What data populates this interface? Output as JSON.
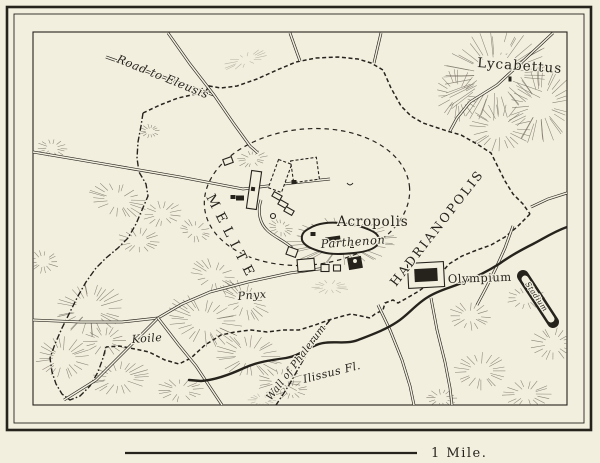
{
  "colors": {
    "paper": "#f2efdf",
    "ink": "#26231d",
    "hachure": "#6e675a"
  },
  "map": {
    "scale_bar": {
      "label": "1 Mile."
    },
    "labels": [
      {
        "id": "road-to-eleusis",
        "text": "Road to Eleusis",
        "style": "italic",
        "size": 11.5,
        "x": 116,
        "y": 62,
        "rotate": 22,
        "spacing": 0.5
      },
      {
        "id": "lycabettus",
        "text": "Lycabettus",
        "style": "roman",
        "size": 13.5,
        "x": 477,
        "y": 67,
        "rotate": 4,
        "spacing": 1
      },
      {
        "id": "melite",
        "text": "MELITE",
        "style": "caps",
        "size": 13.5,
        "x": 206,
        "y": 197,
        "rotate": 63,
        "spacing": 6.5
      },
      {
        "id": "acropolis",
        "text": "Acropolis",
        "style": "roman",
        "size": 13.5,
        "x": 337,
        "y": 226,
        "rotate": 0,
        "spacing": 0.8
      },
      {
        "id": "parthenon",
        "text": "Parthenon",
        "style": "italic",
        "size": 11.5,
        "x": 321,
        "y": 248,
        "rotate": -4,
        "spacing": 0.5
      },
      {
        "id": "hadrianopolis",
        "text": "HADRIANOPOLIS",
        "style": "caps",
        "size": 12.5,
        "x": 396,
        "y": 287,
        "rotate": -52,
        "spacing": 2.2
      },
      {
        "id": "olympium",
        "text": "Olympium",
        "style": "roman",
        "size": 11.5,
        "x": 448,
        "y": 283,
        "rotate": -2,
        "spacing": 0.5
      },
      {
        "id": "pnyx",
        "text": "Pnyx",
        "style": "italic",
        "size": 11,
        "x": 238,
        "y": 300,
        "rotate": -5,
        "spacing": 0.5
      },
      {
        "id": "koile",
        "text": "Koile",
        "style": "italic",
        "size": 11,
        "x": 132,
        "y": 343,
        "rotate": -4,
        "spacing": 0.5
      },
      {
        "id": "wall-of-phalerum",
        "text": "Wall of Phalerum",
        "style": "italic",
        "size": 10,
        "x": 271,
        "y": 401,
        "rotate": -53,
        "spacing": 0.3
      },
      {
        "id": "ilissus-fluvius",
        "text": "Ilissus Fl.",
        "style": "italic",
        "size": 11,
        "x": 304,
        "y": 383,
        "rotate": -14,
        "spacing": 0.5
      },
      {
        "id": "stadium",
        "text": "Stadium",
        "style": "italic",
        "size": 7.5,
        "x": 525,
        "y": 284,
        "rotate": 56,
        "spacing": 0.3
      }
    ],
    "features": [
      {
        "id": "city-wall-north",
        "type": "wall",
        "path": "M143,113 L160,105 L178,98 L196,94 L206,91 L209,86 L221,88 L237,86 L257,79 L277,70 L296,62 L316,58 L338,57 L358,59 L371,63 L383,70 L391,88 L401,106 L411,116 L423,123 L447,131 L461,135 L477,144 L491,153 L498,167 L505,181 L513,194 L523,204 L530,214"
      },
      {
        "id": "city-wall-east",
        "type": "wall",
        "path": "M530,214 L517,227 L505,237 L491,245 L477,250 L462,256 L449,264 L443,271 L431,282 L419,291 L407,298 L398,303 L393,300 L385,303 L383,310 L375,314 L370,318"
      },
      {
        "id": "city-wall-south",
        "type": "wall",
        "path": "M370,318 L361,316 L351,314 L343,316 L329,320 L315,325 L299,330 L283,330 L267,332 L251,330 L235,332 L221,335 L205,345 L191,358 L179,364 L165,360 L149,352 L135,349 L119,346 L106,347"
      },
      {
        "id": "city-wall-west",
        "type": "wall-dashdot",
        "path": "M143,113 L141,126 L138,142 L137,158 L139,172 L146,184 L148,196 L142,210 L136,224 L128,238 L118,248 L106,258 L96,268 L86,282 L78,296 L70,312 L62,328 L55,344 L50,358 L52,372 L56,384 L62,394 L70,400 L80,396 L90,386 L98,372 L103,358 L106,347"
      },
      {
        "id": "phalerum-wall",
        "type": "wall-dashdot",
        "path": "M330,320 L321,331 L313,343 L305,357 L297,371 L289,385 L282,396 L276,405"
      },
      {
        "id": "old-city-boundary",
        "type": "boundary",
        "cx": 307,
        "cy": 197,
        "rx": 103,
        "ry": 68,
        "rot": -6
      },
      {
        "id": "road-to-eleusis-west",
        "type": "road",
        "path": "M106,57 L160,76 L214,95"
      },
      {
        "id": "road-to-eleusis-north",
        "type": "road",
        "path": "M168,33 L190,64 L214,95 L234,124 L250,146 L258,153"
      },
      {
        "id": "north-road-a",
        "type": "road",
        "path": "M290,33 L296,50 L300,61"
      },
      {
        "id": "north-road-b",
        "type": "road",
        "path": "M381,33 L377,50 L374,63"
      },
      {
        "id": "lycabettus-road",
        "type": "road",
        "path": "M553,33 L522,62 L497,85 L470,102 L457,118 L450,131"
      },
      {
        "id": "east-gate-road",
        "type": "road",
        "path": "M567,193 L548,199 L531,207"
      },
      {
        "id": "agora-road",
        "type": "road",
        "path": "M33,152 L110,165 L180,177 L243,189 L292,183 L330,179"
      },
      {
        "id": "south-road",
        "type": "road",
        "path": "M33,320 L80,322 L122,322 L158,318 L182,304 L210,292 L248,282 L290,273 L326,268"
      },
      {
        "id": "southwest-road",
        "type": "road",
        "path": "M64,400 L96,380 L124,352 L158,318"
      },
      {
        "id": "south-branch-road",
        "type": "road",
        "path": "M158,318 L178,344 L196,366 L212,390 L222,405"
      },
      {
        "id": "southeast-road-a",
        "type": "road",
        "path": "M378,305 L390,330 L402,360 L410,386 L414,405"
      },
      {
        "id": "southeast-road-b",
        "type": "road",
        "path": "M431,298 L437,330 L445,362 L450,388 L452,405"
      },
      {
        "id": "stadium-road",
        "type": "road",
        "path": "M513,226 L505,248 L496,268 L486,288 L477,305"
      },
      {
        "id": "acropolis-approach",
        "type": "road",
        "path": "M261,200 C257,212 260,224 268,231 C276,238 285,241 292,248"
      },
      {
        "id": "ilissus-river",
        "type": "river",
        "path": "M567,227 C553,232 543,239 533,244 C521,250 510,256 499,264 C488,271 476,277 464,282 C450,288 439,290 428,297 C416,304 408,315 397,322 C385,330 371,335 358,340 C345,345 331,340 319,344 C307,348 299,356 286,358 C271,360 257,362 244,368 C229,375 215,380 201,381 L189,380"
      },
      {
        "id": "acropolis-citadel",
        "type": "citadel",
        "path": "M310,228 C318,223 330,222 340,223 C352,224 364,227 372,231 C378,234 381,239 378,244 C374,250 364,252 354,253 C344,254 332,255 322,252 C312,249 304,246 302,240 C301,234 304,231 310,228 Z"
      },
      {
        "id": "stadium-track",
        "type": "stadium",
        "path": "M523,276 L553,322",
        "inner": "M525,279 L551,319"
      },
      {
        "id": "lycabettus-summit",
        "type": "clearing",
        "cx": 505,
        "cy": 48,
        "r": 6
      },
      {
        "id": "monument-mark",
        "type": "mark",
        "path": "M347,183 q3,4 6,0"
      }
    ],
    "hills": [
      [
        495,
        75,
        48,
        36,
        -18,
        0
      ],
      [
        540,
        105,
        26,
        34,
        8,
        0
      ],
      [
        500,
        128,
        26,
        20,
        0,
        0
      ],
      [
        458,
        95,
        18,
        22,
        0,
        0
      ],
      [
        246,
        60,
        20,
        6,
        -20,
        1
      ],
      [
        52,
        148,
        13,
        8,
        0,
        0
      ],
      [
        150,
        131,
        8,
        6,
        0,
        0
      ],
      [
        118,
        200,
        25,
        14,
        18,
        0
      ],
      [
        162,
        214,
        17,
        11,
        -8,
        0
      ],
      [
        195,
        231,
        14,
        9,
        25,
        0
      ],
      [
        139,
        241,
        19,
        11,
        0,
        0
      ],
      [
        252,
        159,
        13,
        7,
        -12,
        0
      ],
      [
        281,
        228,
        11,
        7,
        20,
        0
      ],
      [
        342,
        241,
        46,
        20,
        -3,
        0
      ],
      [
        330,
        287,
        16,
        6,
        0,
        1
      ],
      [
        214,
        276,
        21,
        13,
        30,
        0
      ],
      [
        245,
        301,
        23,
        13,
        40,
        0
      ],
      [
        204,
        321,
        33,
        20,
        20,
        0
      ],
      [
        249,
        356,
        28,
        18,
        10,
        0
      ],
      [
        280,
        382,
        20,
        12,
        0,
        0
      ],
      [
        90,
        309,
        28,
        23,
        0,
        0
      ],
      [
        63,
        358,
        23,
        18,
        0,
        0
      ],
      [
        119,
        378,
        26,
        14,
        -10,
        0
      ],
      [
        180,
        390,
        20,
        10,
        0,
        0
      ],
      [
        43,
        262,
        13,
        10,
        0,
        0
      ],
      [
        105,
        341,
        18,
        12,
        0,
        0
      ],
      [
        470,
        316,
        18,
        12,
        0,
        0
      ],
      [
        526,
        298,
        16,
        10,
        0,
        0
      ],
      [
        553,
        344,
        19,
        14,
        0,
        0
      ],
      [
        481,
        371,
        23,
        16,
        0,
        0
      ],
      [
        527,
        394,
        21,
        12,
        0,
        0
      ],
      [
        441,
        398,
        13,
        8,
        0,
        0
      ],
      [
        291,
        390,
        14,
        8,
        0,
        0
      ],
      [
        262,
        400,
        12,
        6,
        0,
        1
      ]
    ],
    "buildings": [
      {
        "id": "stoa",
        "cx": 254,
        "cy": 190,
        "w": 10,
        "h": 38,
        "rot": 8,
        "fill": "light"
      },
      {
        "id": "stoa-dot",
        "cx": 253,
        "cy": 189,
        "w": 4,
        "h": 4,
        "rot": 8,
        "fill": "dark"
      },
      {
        "id": "agora-block-a",
        "cx": 280,
        "cy": 176,
        "w": 14,
        "h": 30,
        "rot": 20,
        "fill": "light",
        "dash": true
      },
      {
        "id": "agora-block-b",
        "cx": 305,
        "cy": 170,
        "w": 26,
        "h": 22,
        "rot": -8,
        "fill": "light",
        "dash": true
      },
      {
        "id": "agora-dot",
        "cx": 294,
        "cy": 182,
        "w": 5,
        "h": 4,
        "rot": 0,
        "fill": "dark"
      },
      {
        "id": "agora-row-1",
        "cx": 277,
        "cy": 196,
        "w": 9,
        "h": 5,
        "rot": 30,
        "fill": "light"
      },
      {
        "id": "agora-row-2",
        "cx": 283,
        "cy": 204,
        "w": 9,
        "h": 5,
        "rot": 30,
        "fill": "light"
      },
      {
        "id": "agora-row-3",
        "cx": 289,
        "cy": 211,
        "w": 9,
        "h": 5,
        "rot": 30,
        "fill": "light"
      },
      {
        "id": "tholos",
        "shape": "circle",
        "cx": 273,
        "cy": 216,
        "r": 2.5,
        "fill": "light"
      },
      {
        "id": "temple-nw",
        "cx": 228,
        "cy": 161,
        "w": 9,
        "h": 6,
        "rot": -20,
        "fill": "light"
      },
      {
        "id": "small-dark-a",
        "cx": 240,
        "cy": 198,
        "w": 8,
        "h": 5,
        "rot": 0,
        "fill": "dark"
      },
      {
        "id": "small-dark-b",
        "cx": 233,
        "cy": 197,
        "w": 5,
        "h": 4,
        "rot": 0,
        "fill": "dark"
      },
      {
        "id": "parthenon-building",
        "cx": 333,
        "cy": 240,
        "w": 15,
        "h": 7,
        "rot": -8,
        "fill": "dark"
      },
      {
        "id": "erechtheum",
        "cx": 313,
        "cy": 234,
        "w": 5,
        "h": 4,
        "rot": 0,
        "fill": "dark"
      },
      {
        "id": "acropolis-small",
        "cx": 352,
        "cy": 246,
        "w": 4,
        "h": 4,
        "rot": 0,
        "fill": "dark"
      },
      {
        "id": "odeum",
        "cx": 306,
        "cy": 265,
        "w": 17,
        "h": 12,
        "rot": -5,
        "fill": "light"
      },
      {
        "id": "south-slope-a",
        "cx": 325,
        "cy": 268,
        "w": 8,
        "h": 7,
        "rot": 0,
        "fill": "light"
      },
      {
        "id": "south-slope-b",
        "cx": 337,
        "cy": 268,
        "w": 7,
        "h": 6,
        "rot": 0,
        "fill": "light"
      },
      {
        "id": "theatre",
        "cx": 355,
        "cy": 263,
        "w": 14,
        "h": 12,
        "rot": -10,
        "fill": "dark"
      },
      {
        "id": "theatre-cavea",
        "shape": "circle",
        "cx": 355,
        "cy": 261,
        "r": 2.5,
        "fill": "light"
      },
      {
        "id": "west-slope-building",
        "cx": 292,
        "cy": 252,
        "w": 10,
        "h": 8,
        "rot": 20,
        "fill": "light"
      },
      {
        "id": "olympium-enclosure",
        "cx": 426,
        "cy": 275,
        "w": 36,
        "h": 25,
        "rot": -3,
        "fill": "light"
      },
      {
        "id": "olympium-temple",
        "cx": 426,
        "cy": 275,
        "w": 23,
        "h": 13,
        "rot": -3,
        "fill": "dark"
      },
      {
        "id": "lycabettus-chapel",
        "cx": 510,
        "cy": 79,
        "w": 3,
        "h": 5,
        "rot": 0,
        "fill": "dark"
      }
    ]
  }
}
